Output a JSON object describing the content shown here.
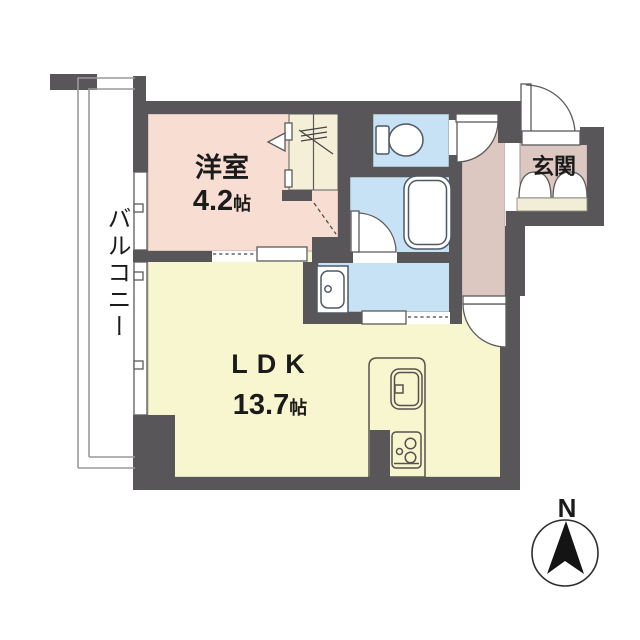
{
  "floorplan": {
    "type": "apartment-floor-plan",
    "balcony": {
      "label": "バルコニー"
    },
    "western_room": {
      "name": "洋室",
      "size_value": "4.2",
      "size_unit": "帖"
    },
    "ldk": {
      "name": "LDK",
      "size_value": "13.7",
      "size_unit": "帖"
    },
    "entrance": {
      "name": "玄関"
    },
    "compass": {
      "north_label": "N"
    },
    "fixtures": [
      "toilet",
      "bathtub",
      "washbasin-vanity",
      "kitchen-sink",
      "gas-stove",
      "closet-with-hanger",
      "entrance-door",
      "shoe-cabinet",
      "sliding-doors",
      "windows"
    ],
    "colors": {
      "wall": "#595659",
      "western_room_floor": "#f8ddd2",
      "ldk_floor": "#f8f6cf",
      "wet_area_floor": "#c6e2f4",
      "hallway_floor": "#ddc7c1",
      "closet_floor": "#f5efd8",
      "shoe_cabinet_top": "#f1edd6"
    }
  }
}
